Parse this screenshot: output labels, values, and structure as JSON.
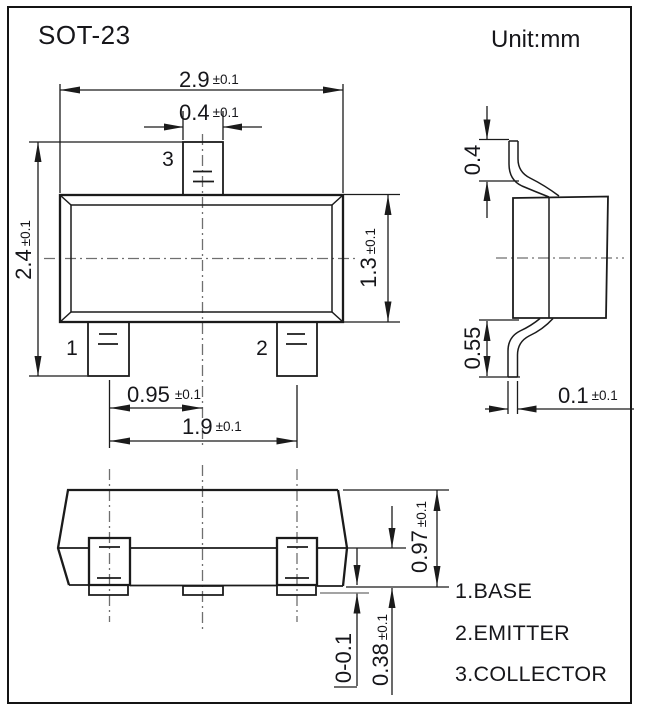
{
  "title": "SOT-23",
  "unit_label": "Unit:mm",
  "colors": {
    "line": "#1b1b1b",
    "centerline": "#6f6f6f",
    "reference_gray": "#a3a3a3",
    "background": "#ffffff"
  },
  "top_view": {
    "pin_labels": {
      "pin1": "1",
      "pin2": "2",
      "pin3": "3"
    },
    "dims": {
      "body_width": {
        "value": "2.9",
        "tol": "±0.1"
      },
      "lead_width": {
        "value": "0.4",
        "tol": "±0.1"
      },
      "overall_height": {
        "value": "2.4",
        "tol": "±0.1"
      },
      "body_height": {
        "value": "1.3",
        "tol": "±0.1"
      },
      "lead_pitch": {
        "value": "0.95",
        "tol": "±0.1"
      },
      "lead_span": {
        "value": "1.9",
        "tol": "±0.1"
      }
    }
  },
  "side_view": {
    "dims": {
      "lead_top_length": {
        "value": "0.4"
      },
      "lead_bottom_length": {
        "value": "0.55"
      },
      "lead_thickness": {
        "value": "0.1",
        "tol": "±0.1"
      }
    }
  },
  "front_view": {
    "dims": {
      "body_height": {
        "value": "0.97",
        "tol": "±0.1"
      },
      "standoff": {
        "value": "0-0.1"
      },
      "lead_foot_height": {
        "value": "0.38",
        "tol": "±0.1"
      }
    }
  },
  "legend": {
    "items": [
      {
        "label": "1.BASE"
      },
      {
        "label": "2.EMITTER"
      },
      {
        "label": "3.COLLECTOR"
      }
    ]
  }
}
